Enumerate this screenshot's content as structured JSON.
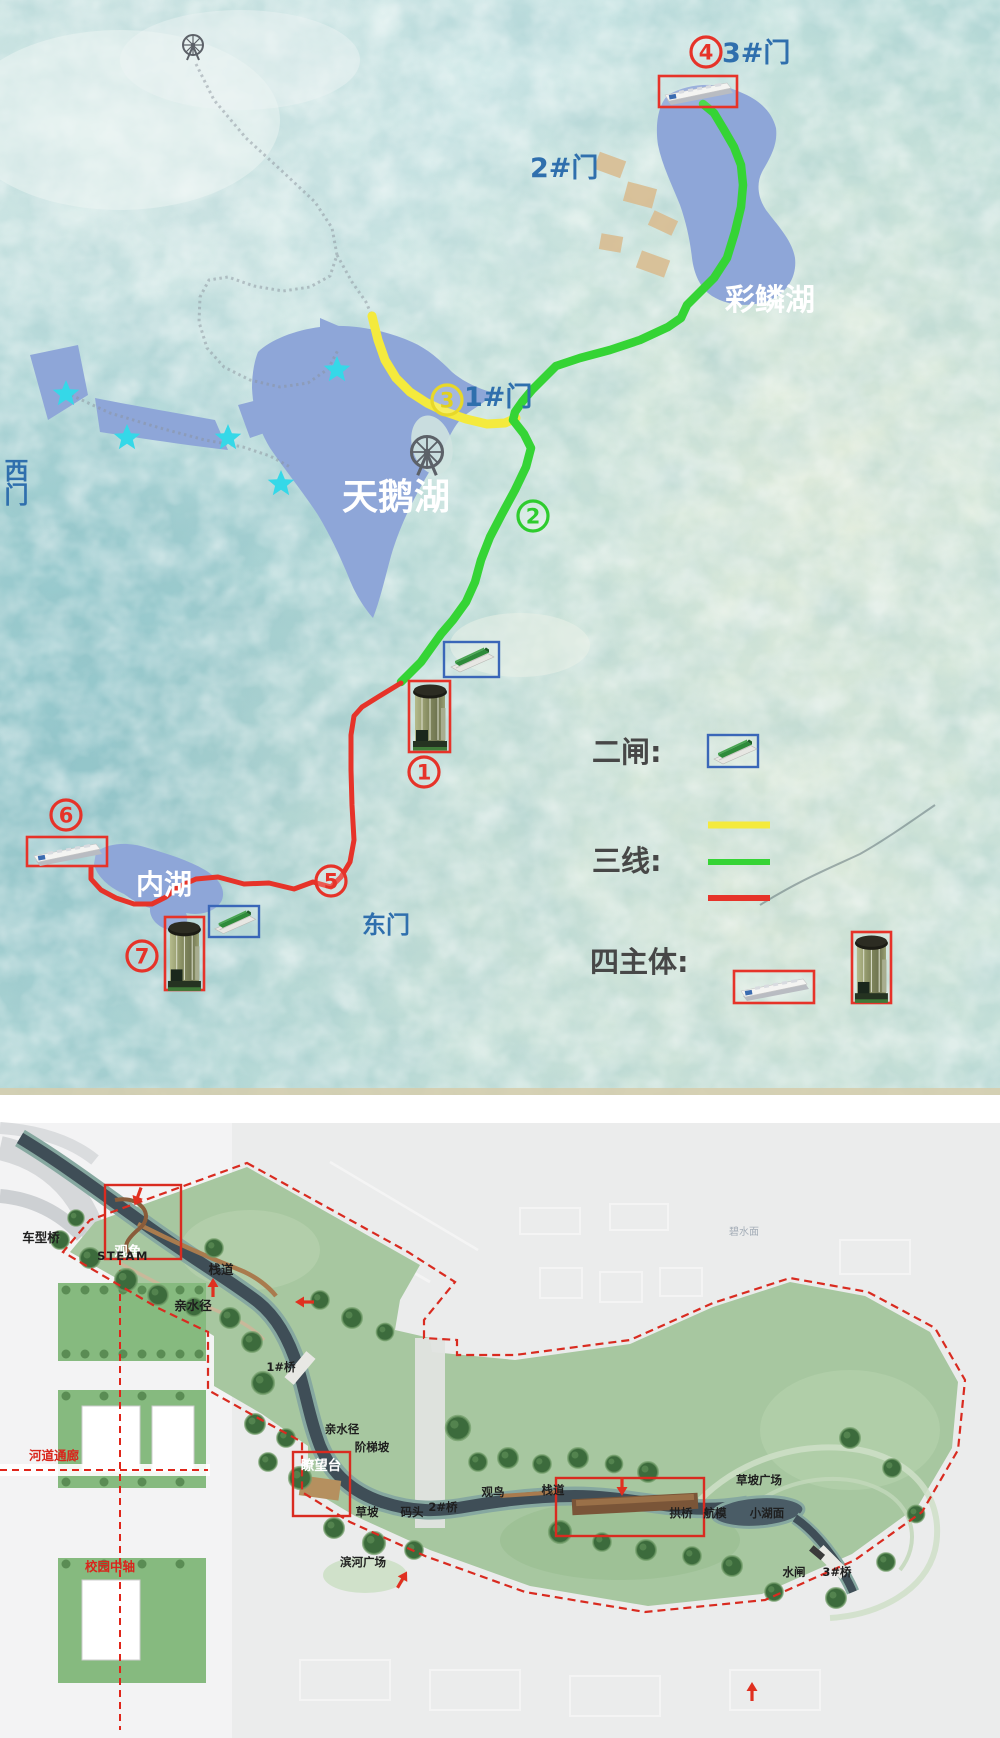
{
  "colors": {
    "route_yellow": "#f4ea3d",
    "route_green": "#35d435",
    "route_red": "#e63329",
    "gate_text_blue": "#2f6fad",
    "lake_fill": "#8ea6d8",
    "legend_text": "#474747",
    "boundary_red": "#d92b20",
    "star_cyan": "#35d8e8"
  },
  "top_map": {
    "gates": {
      "gate3": "3#门",
      "gate2": "2#门",
      "gate1": "1#门",
      "west": "西门",
      "east": "东门"
    },
    "lakes": {
      "swan": "天鹅湖",
      "cailin": "彩鳞湖",
      "inner": "内湖"
    },
    "markers": {
      "m1": "1",
      "m2": "2",
      "m3": "3",
      "m4": "4",
      "m5": "5",
      "m6": "6",
      "m7": "7"
    },
    "legend": {
      "gates": "二闸:",
      "lines": "三线:",
      "bodies": "四主体:"
    }
  },
  "bottom_map": {
    "labels": {
      "chexingqiao": "车型桥",
      "guanyu": "观鱼",
      "zhandao_a": "栈道",
      "qinshuijing_a": "亲水径",
      "steam": "STEAM",
      "bridge1": "1#桥",
      "qinshuijing_b": "亲水径",
      "jietipo": "阶梯坡",
      "liaowangtai": "瞭望台",
      "caopo": "草坡",
      "matou": "码头",
      "bridge2": "2#桥",
      "binhe_guangchang": "滨河广场",
      "guanniao": "观鸟",
      "zhandao_b": "栈道",
      "caopo_guangchang": "草坡广场",
      "gongqiao": "拱桥",
      "hangmo": "航模",
      "xiaohumian": "小湖面",
      "shuizha": "水闸",
      "bridge3": "3#桥",
      "hedao_tonglang": "河道通廊",
      "xiaoyuan_zhongzhou": "校园中轴",
      "bishuimian": "碧水面"
    }
  }
}
